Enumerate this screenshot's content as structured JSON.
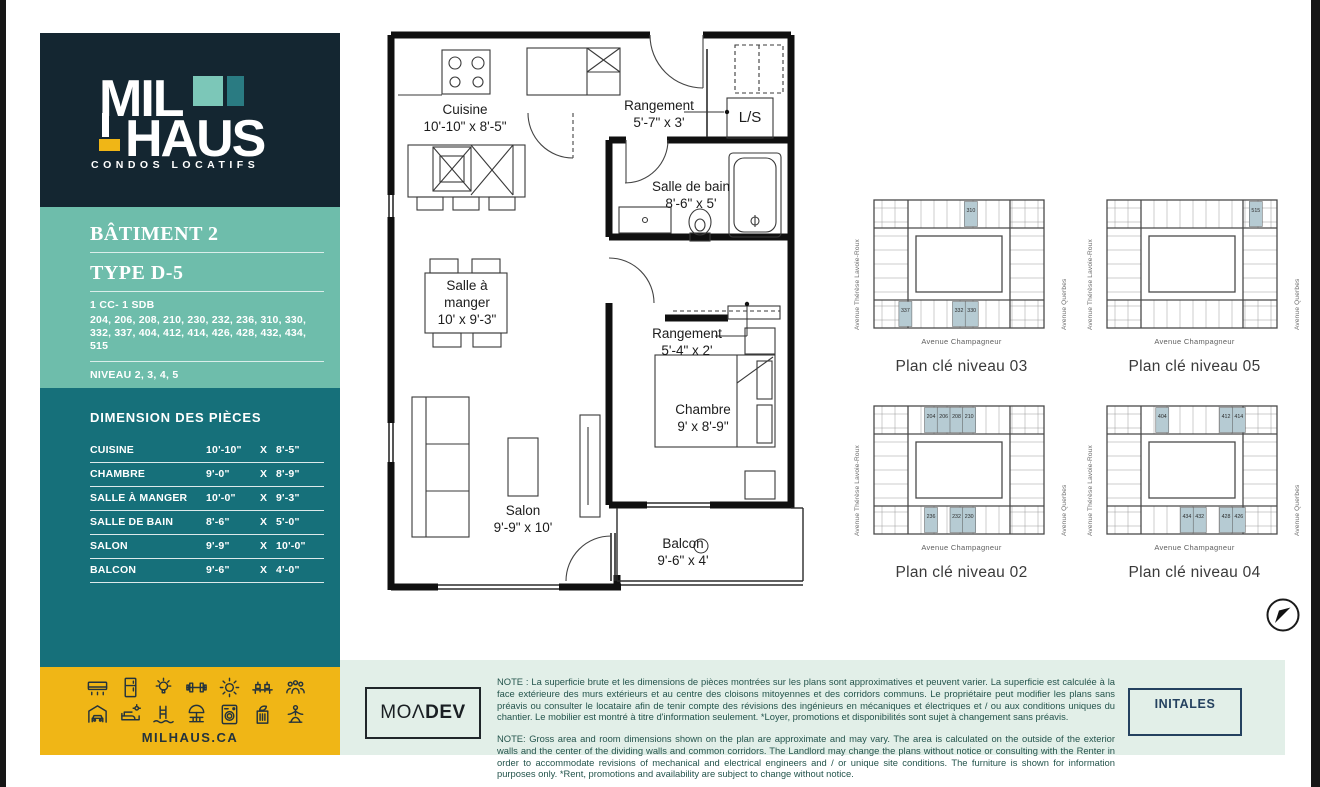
{
  "colors": {
    "navy": "#142631",
    "teal_light": "#6ebdab",
    "teal_dark": "#16707a",
    "yellow": "#f0b616",
    "mint_band": "#e2efe8",
    "keyplan_highlight": "#b6cbd3",
    "logo_square_light": "#7cc7b8",
    "logo_square_dark": "#2a7b82"
  },
  "sidebar": {
    "logo": {
      "line1": "MIL",
      "line2": "HAUS",
      "tagline": "CONDOS LOCATIFS"
    },
    "building_title": "BÂTIMENT 2",
    "type_title": "TYPE D-5",
    "config": "1 CC- 1 SDB",
    "units": "204, 206, 208, 210, 230, 232, 236, 310, 330, 332, 337, 404, 412, 414, 426, 428, 432, 434, 515",
    "level_label": "NIVEAU 2, 3, 4, 5",
    "area_label": "SUPERFICIE",
    "area_value": "UNITÉ : 536 PI²",
    "dimensions": {
      "title": "DIMENSION DES PIÈCES",
      "separator": "X",
      "rows": [
        {
          "name": "CUISINE",
          "a": "10'-10\"",
          "b": "8'-5\""
        },
        {
          "name": "CHAMBRE",
          "a": "9'-0\"",
          "b": "8'-9\""
        },
        {
          "name": "SALLE À MANGER",
          "a": "10'-0\"",
          "b": "9'-3\""
        },
        {
          "name": "SALLE DE BAIN",
          "a": "8'-6\"",
          "b": "5'-0\""
        },
        {
          "name": "SALON",
          "a": "9'-9\"",
          "b": "10'-0\""
        },
        {
          "name": "BALCON",
          "a": "9'-6\"",
          "b": "4'-0\""
        }
      ]
    },
    "footer": {
      "icons": [
        "air-conditioner",
        "refrigerator",
        "lightbulb",
        "gym-dumbbell",
        "sun",
        "coworking-desks",
        "community-people",
        "indoor-parking",
        "lounge-terrace",
        "pool-ladder",
        "patio-umbrella",
        "laundry-machine",
        "recycling-room",
        "yoga-room"
      ],
      "website": "MILHAUS.CA"
    }
  },
  "floorplan": {
    "rooms": {
      "cuisine": {
        "name": "Cuisine",
        "dims": "10'-10\" x 8'-5\""
      },
      "rangement_haut": {
        "name": "Rangement",
        "dims": "5'-7\" x 3'"
      },
      "buanderie": {
        "name": "L/S"
      },
      "salle_de_bain": {
        "name": "Salle de bain",
        "dims": "8'-6\" x 5'"
      },
      "salle_a_manger": {
        "name": "Salle à manger",
        "dims": "10' x 9'-3\""
      },
      "rangement_bas": {
        "name": "Rangement",
        "dims": "5'-4\" x 2'"
      },
      "chambre": {
        "name": "Chambre",
        "dims": "9' x 8'-9\""
      },
      "salon": {
        "name": "Salon",
        "dims": "9'-9\" x 10'"
      },
      "balcon": {
        "name": "Balcon",
        "dims": "9'-6\" x 4'"
      }
    }
  },
  "keyplans": {
    "streets": {
      "left": "Avenue Thérèse Lavoie-Roux",
      "right": "Avenue Querbes",
      "bottom": "Avenue Champagneur"
    },
    "plans": [
      {
        "label": "Plan clé niveau 03",
        "top": [
          {
            "unit": "310",
            "fx": 0.57
          }
        ],
        "bottom": [
          {
            "unit": "337",
            "fx": 0.185
          },
          {
            "unit": "332",
            "fx": 0.5
          },
          {
            "unit": "330",
            "fx": 0.575
          }
        ]
      },
      {
        "label": "Plan clé niveau 05",
        "top": [
          {
            "unit": "515",
            "fx": 0.875
          }
        ],
        "bottom": []
      },
      {
        "label": "Plan clé niveau 02",
        "top": [
          {
            "unit": "204",
            "fx": 0.335
          },
          {
            "unit": "206",
            "fx": 0.41
          },
          {
            "unit": "208",
            "fx": 0.485
          },
          {
            "unit": "210",
            "fx": 0.56
          }
        ],
        "bottom": [
          {
            "unit": "236",
            "fx": 0.335
          },
          {
            "unit": "232",
            "fx": 0.485
          },
          {
            "unit": "230",
            "fx": 0.56
          }
        ]
      },
      {
        "label": "Plan clé niveau 04",
        "top": [
          {
            "unit": "404",
            "fx": 0.325
          },
          {
            "unit": "412",
            "fx": 0.7
          },
          {
            "unit": "414",
            "fx": 0.775
          }
        ],
        "bottom": [
          {
            "unit": "434",
            "fx": 0.47
          },
          {
            "unit": "432",
            "fx": 0.545
          },
          {
            "unit": "428",
            "fx": 0.7
          },
          {
            "unit": "426",
            "fx": 0.775
          }
        ]
      }
    ]
  },
  "legal": {
    "note_fr": "NOTE : La superficie brute et les dimensions de pièces montrées sur les plans sont approximatives et peuvent varier. La superficie est calculée à la face extérieure des murs extérieurs et au centre des cloisons mitoyennes et des corridors communs. Le propriétaire peut modifier les plans sans préavis ou consulter le locataire afin de tenir compte des révisions des ingénieurs en mécaniques et électriques et / ou aux conditions uniques du chantier. Le mobilier est montré à titre d'information seulement. *Loyer, promotions et disponibilités sont sujet à changement sans préavis.",
    "note_en": "NOTE: Gross area and room dimensions shown on the plan are approximate and may vary. The area is calculated on the outside of the exterior walls and the center of the dividing walls and common corridors. The Landlord may change the plans without notice or consulting with the Renter in order to accommodate revisions of mechanical and electrical engineers and / or unique site conditions. The furniture is shown for information purposes only. *Rent, promotions and availability are subject to change without notice."
  },
  "branding": {
    "developer_left": "MOΛ",
    "developer_right": "DEV"
  },
  "signature": {
    "label": "INITALES"
  }
}
